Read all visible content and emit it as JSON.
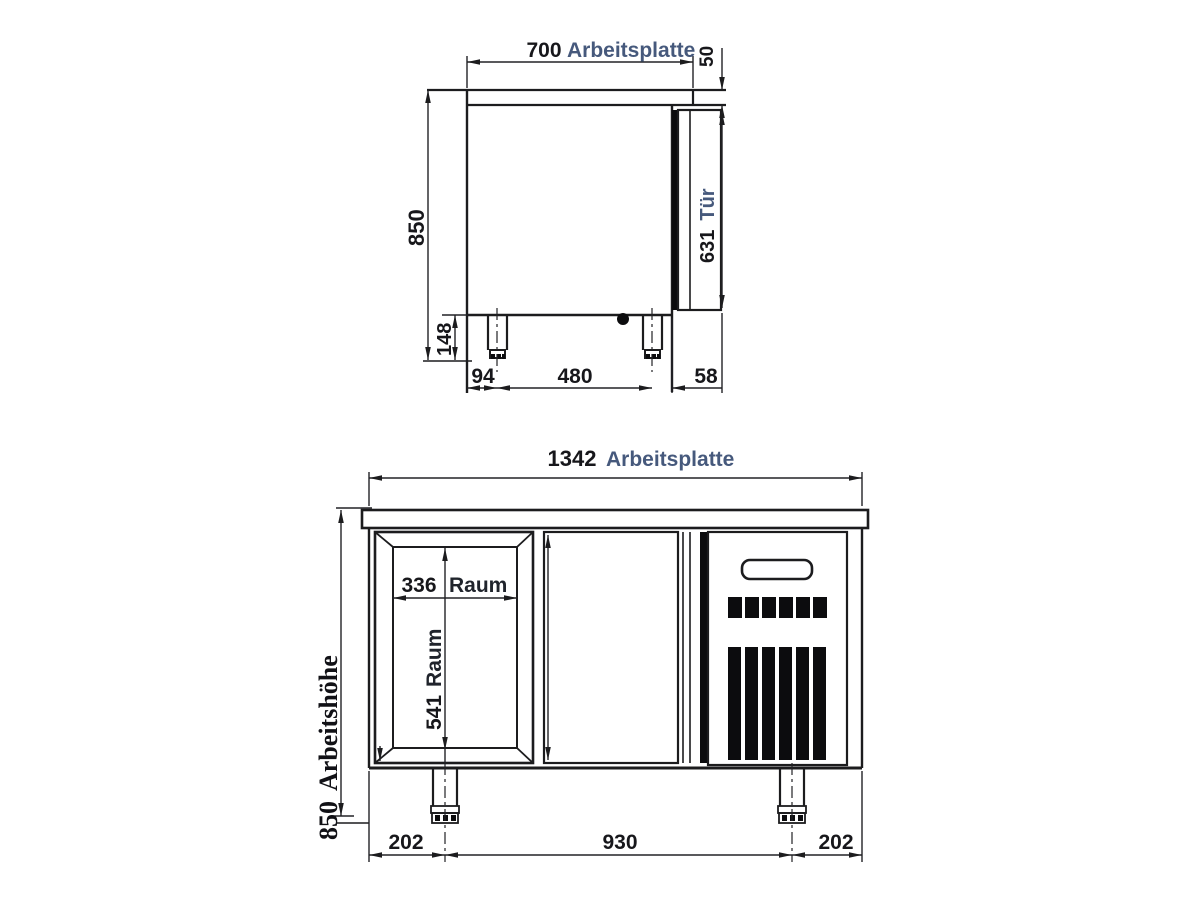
{
  "colors": {
    "line": "#1c1c1e",
    "dimension_number": "#17171b",
    "label_blue": "#46597c",
    "serif_text": "#111116",
    "background": "#ffffff"
  },
  "side_view": {
    "worktop_width": "700",
    "worktop_label": "Arbeitsplatte",
    "worktop_thickness": "50",
    "overall_height": "850",
    "door_height": "631",
    "door_label": "Tür",
    "leg_height": "148",
    "front_offset": "94",
    "leg_spacing": "480",
    "rear_offset": "58"
  },
  "front_view": {
    "worktop_width": "1342",
    "worktop_label": "Arbeitsplatte",
    "working_height": "850",
    "working_height_label": "Arbeitshöhe",
    "compartment_width": "336",
    "compartment_width_label": "Raum",
    "compartment_height": "541",
    "compartment_height_label": "Raum",
    "left_offset": "202",
    "leg_spacing": "930",
    "right_offset": "202"
  }
}
